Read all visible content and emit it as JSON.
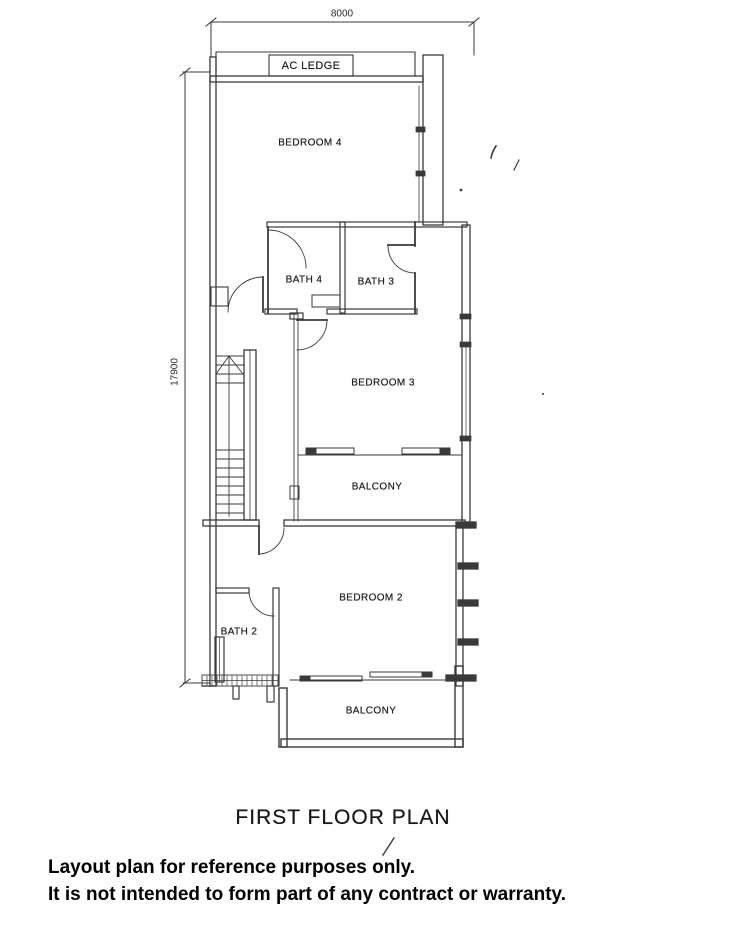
{
  "plan": {
    "dimension_top": "8000",
    "dimension_left": "17900",
    "labels": {
      "ac_ledge": "AC LEDGE",
      "bedroom4": "BEDROOM 4",
      "bath4": "BATH 4",
      "bath3": "BATH 3",
      "bedroom3": "BEDROOM 3",
      "balcony_mid": "BALCONY",
      "bedroom2": "BEDROOM 2",
      "bath2": "BATH 2",
      "balcony_low": "BALCONY"
    },
    "title": "FIRST FLOOR PLAN"
  },
  "disclaimer": {
    "line1": "Layout plan for reference purposes only.",
    "line2": "It is not intended to form part of any contract or warranty."
  },
  "colors": {
    "line": "#3a3a3a",
    "text": "#1c1c1c",
    "disclaimer_text": "#000000",
    "background": "#ffffff"
  }
}
